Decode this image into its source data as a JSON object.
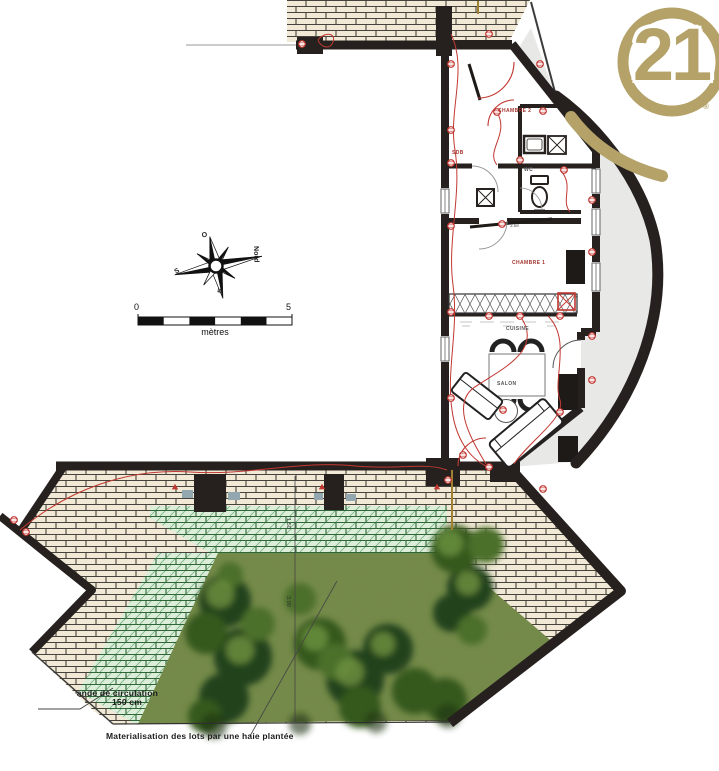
{
  "logo": {
    "number": "21",
    "registered_mark": "®"
  },
  "compass": {
    "north_label": "Nord",
    "south_label": "S",
    "west_label": "O",
    "east_label": "E"
  },
  "scale_bar": {
    "start": "0",
    "end": "5",
    "unit_label": "mètres"
  },
  "floor_plan": {
    "rooms": {
      "bedroom2": "CHAMBRE 2",
      "bathroom": "SDB",
      "wc": "WC",
      "bedroom1": "CHAMBRE 1",
      "kitchen": "CUISINE",
      "living_room": "SALON"
    },
    "room_dimension": "3.58"
  },
  "garden": {
    "dimension_upper": "1.50",
    "dimension_lower": "3.00",
    "circulation_label_line1": "ande de circulation",
    "circulation_label_line2": "150 cm",
    "hedge_label": "Materialisation des lots par une haie plantée"
  },
  "colors": {
    "gold": "#b4a269",
    "wall": "#26211e",
    "red_annotation": "#c13832",
    "brick": "#f1e9d6",
    "green_band": "#dcEEda",
    "grass": "#768b49",
    "gray_area": "#e8e8e6"
  }
}
